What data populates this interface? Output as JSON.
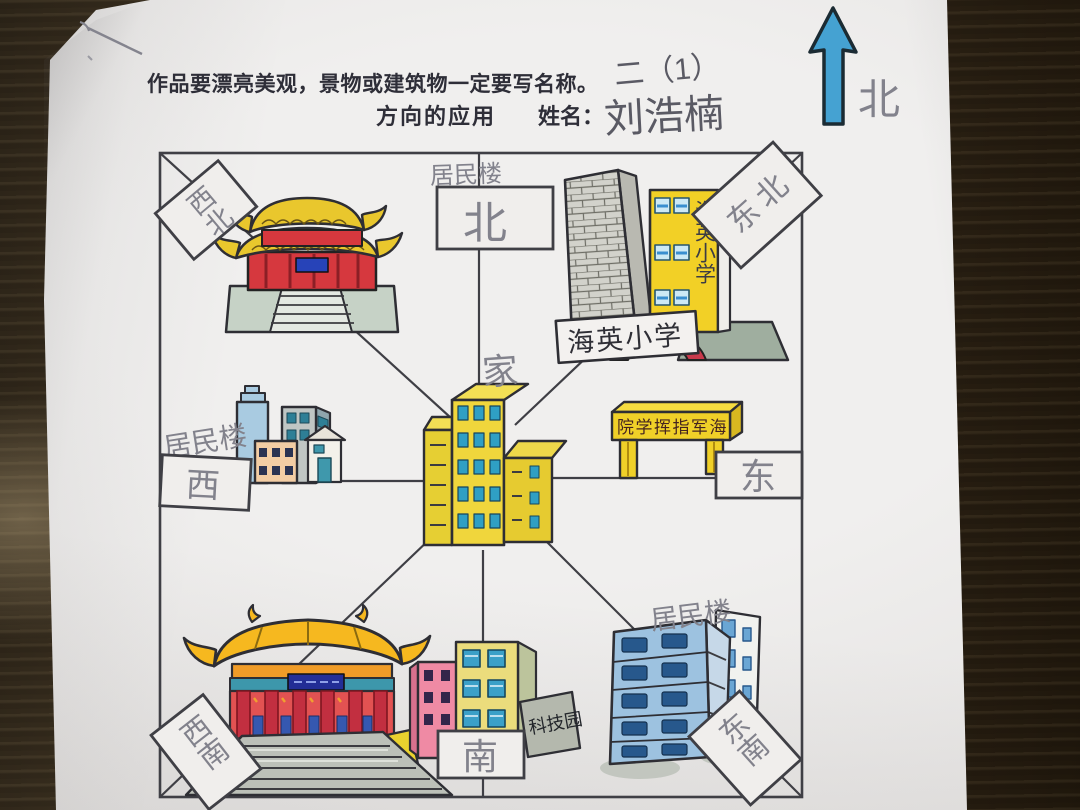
{
  "header": {
    "instruction": "作品要漂亮美观，景物或建筑物一定要写名称。",
    "class_label": "二（1）",
    "title": "方向的应用",
    "name_label": "姓名：",
    "student_name": "刘浩楠"
  },
  "compass": {
    "label": "北"
  },
  "map": {
    "center_label": "家",
    "direction_boxes": {
      "north": "北",
      "south": "南",
      "east": "东",
      "west": "西",
      "northwest": "西北",
      "northeast": "东北",
      "southwest": "西南",
      "southeast": "东南"
    },
    "pencil_notes": {
      "north_building": "居民楼",
      "west_building": "居民楼",
      "southeast_building": "居民楼"
    },
    "signs": {
      "school_banner": "海英小学",
      "school_wall": "海英小学",
      "school_arch": "海英欢迎您",
      "gate_banner": "院学挥指军海",
      "tech_park": "科技园"
    }
  },
  "colors": {
    "table_wood": "#3a2e1f",
    "paper": "#ebe9e8",
    "ink": "#35353b",
    "pencil": "#82828c",
    "arrow_blue": "#45a2d2",
    "marker_yellow": "#f0d22c",
    "marker_red": "#d6383e",
    "window_blue": "#3a9ec6",
    "light_blue": "#9dc2e0",
    "pink": "#ef8aa4",
    "gray_green": "#9fae9f"
  }
}
